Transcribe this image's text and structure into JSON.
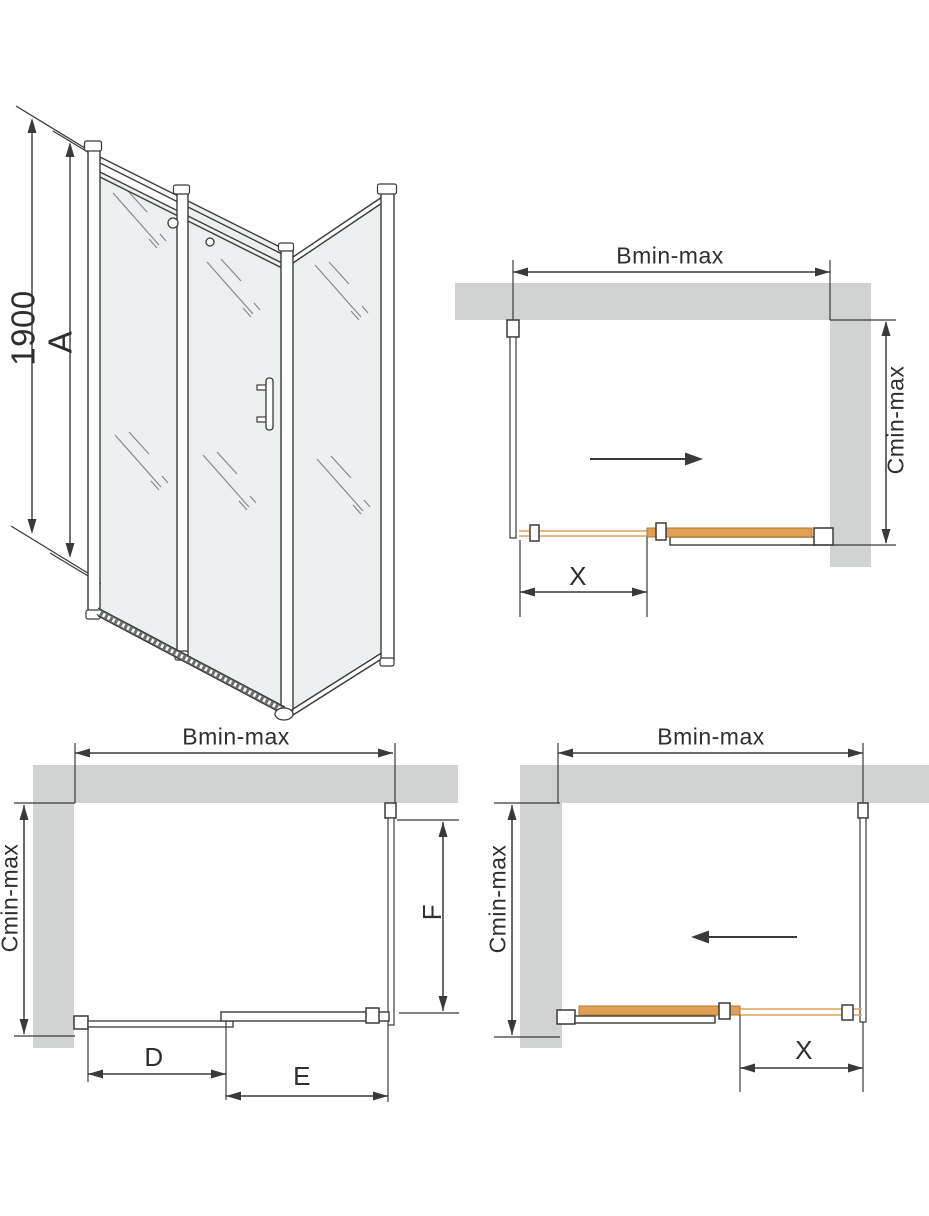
{
  "colors": {
    "background": "#ffffff",
    "wall": "#d1d3d3",
    "line": "#3a3a3a",
    "glass": "#edf0f0",
    "door_fill": "#e0a055",
    "door_edge": "#b5762a",
    "track": "#dda25c",
    "text": "#2e2e2e"
  },
  "isometric_view": {
    "outer_height_label": "1900",
    "inner_height_label": "A"
  },
  "plan_top_right": {
    "width_label": "Bmin-max",
    "depth_label": "Cmin-max",
    "door_travel_label": "X"
  },
  "plan_bottom_left": {
    "width_label": "Bmin-max",
    "depth_label": "Cmin-max",
    "fixed_segment_label": "D",
    "door_segment_label": "E",
    "side_panel_label": "F"
  },
  "plan_bottom_right": {
    "width_label": "Bmin-max",
    "depth_label": "Cmin-max",
    "door_travel_label": "X"
  }
}
